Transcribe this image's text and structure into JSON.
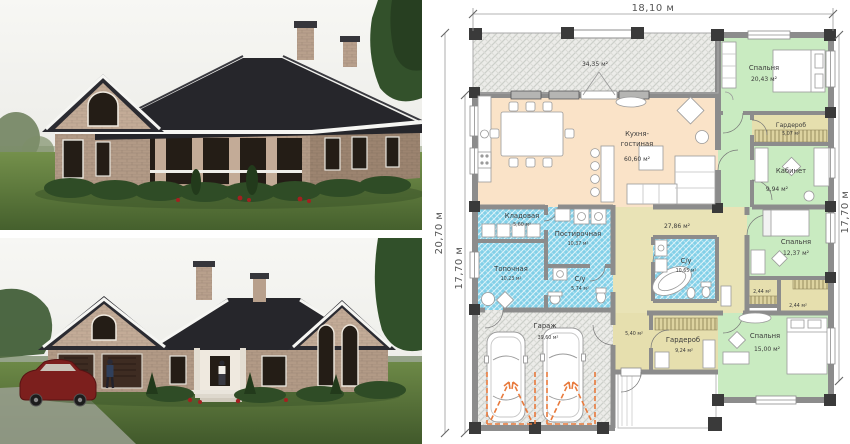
{
  "floor_plan": {
    "dims": {
      "top": "18,10 м",
      "left_outer": "20,70 м",
      "left_inner": "17,70 м",
      "right": "17,70 м"
    },
    "rooms": {
      "terrace": {
        "area": "34,35 м²"
      },
      "kitchen": {
        "name_line1": "Кухня-",
        "name_line2": "гостиная",
        "area": "60,60 м²"
      },
      "bedroom_top": {
        "name": "Спальня",
        "area": "20,43 м²"
      },
      "wardrobe_top": {
        "name": "Гардероб",
        "area": "5,07 м²"
      },
      "office": {
        "name": "Кабинет",
        "area": "9,94 м²"
      },
      "bedroom_mid": {
        "name": "Спальня",
        "area": "12,37 м²"
      },
      "closet_a": {
        "area": "2,44 м²"
      },
      "closet_b": {
        "area": "2,44 м²"
      },
      "bedroom_bottom": {
        "name": "Спальня",
        "area": "15,00 м²"
      },
      "hall": {
        "area": "27,86 м²"
      },
      "bath_main": {
        "name": "С/у",
        "area": "10,65 м²"
      },
      "bath_small": {
        "name": "С/у",
        "area": "5,74 м²"
      },
      "pantry": {
        "name": "Кладовая",
        "area": "5,60 м²"
      },
      "laundry": {
        "name": "Постирочная",
        "area": "10,37 м²"
      },
      "boiler": {
        "name": "Топочная",
        "area": "10,23 м²"
      },
      "garage": {
        "name": "Гараж",
        "area": "39,60 м²"
      },
      "entry": {
        "area": "5,40 м²"
      },
      "wardrobe_bottom": {
        "name": "Гардероб",
        "area": "9,24 м²"
      }
    }
  },
  "colors": {
    "room_green": "#c9ebc1",
    "room_peach": "#fae3c8",
    "room_khaki": "#e9e3b6",
    "room_tan": "#e6dfae",
    "wet_blue": "#82d0e8",
    "wall_gray": "#8c8c8c",
    "door_arrow_orange": "#e87a3c",
    "roof_dark": "#26262b",
    "brick": "#b29a86",
    "brick_light": "#c3ab97",
    "lawn_green": "#5e7b3e",
    "sky": "#f2f2ee",
    "hedge_green": "#2f4c26",
    "car_red": "#7c1f1d"
  }
}
